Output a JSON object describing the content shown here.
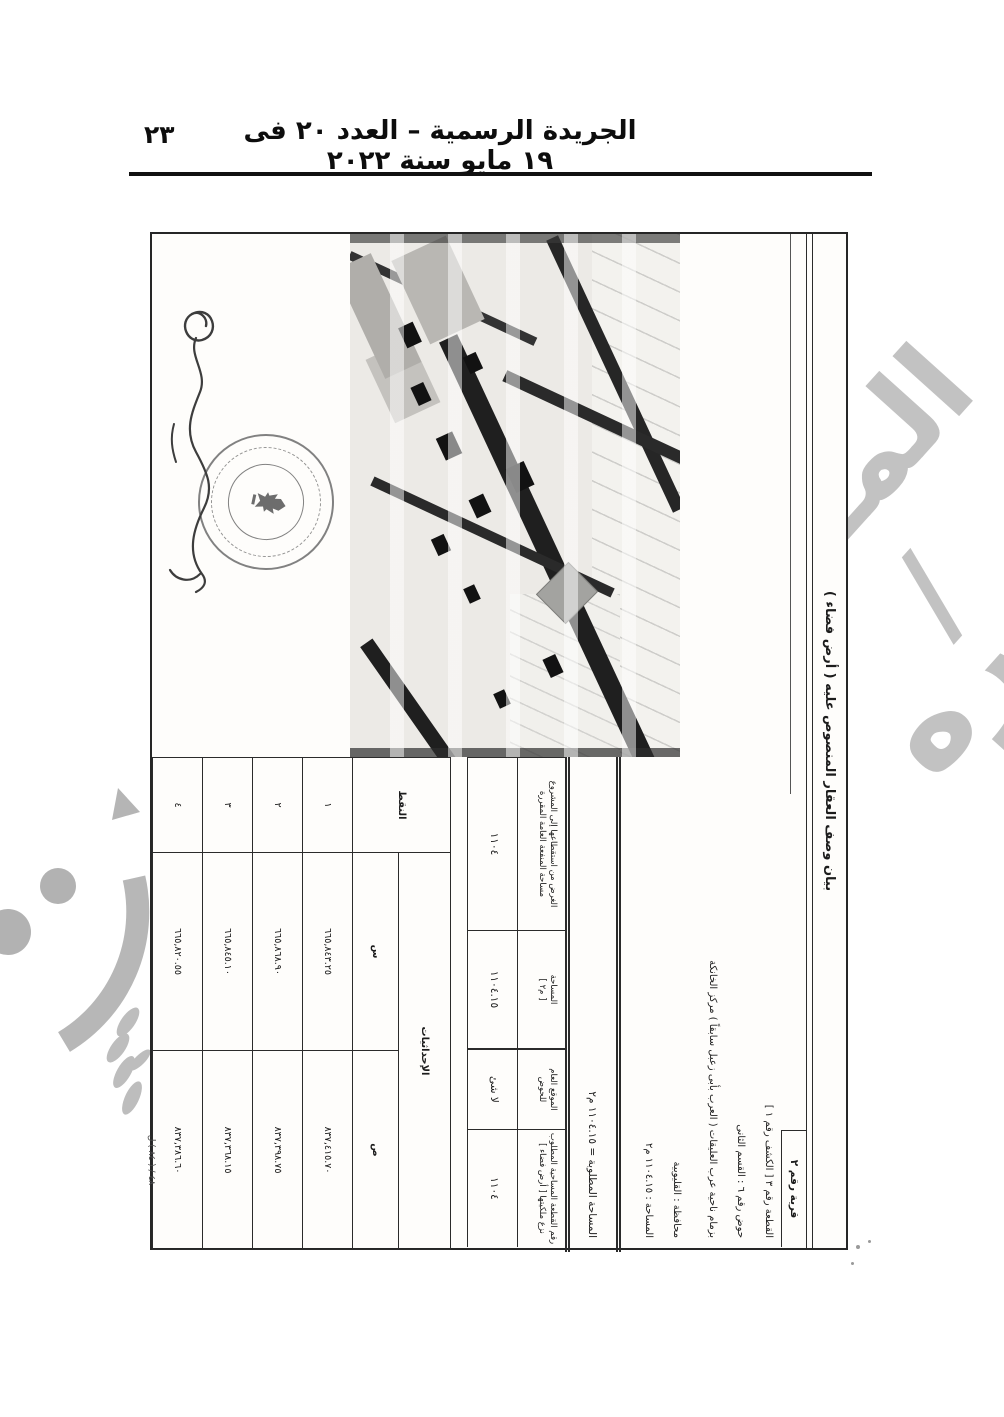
{
  "page": {
    "header": {
      "gazette_title": "الجريدة الرسمية – العدد ٢٠ فى ١٩ مايو سنة ٢٠٢٢",
      "page_number": "٢٣"
    },
    "print_mark": "٤٨ / ( ٨٤ ) ل",
    "watermark": {
      "fragment_top": "المـ /",
      "fragment_bottom": "صوره"
    }
  },
  "doc": {
    "title": "بيان وصف العقار المنصوص عليه ( أرض فضاء )",
    "sheet_label": "قرية رقم ٢",
    "description_lines": [
      "القطعة رقم ٣ [ الكشف رقم ١ ]",
      "حوض رقم ٦ : القسم الثانى",
      "بزمام ناحية عرب العليقات ( العرب بأبى زعبل سابقاً ) مركز الخانكة",
      "محافظة : القليوبية",
      "المساحة : ١١٠٤.١٥ م٢"
    ],
    "summary_line": "المساحة المطلوبة = ١١٠٤.١٥ م٢",
    "parcel_table": {
      "headers": [
        {
          "line1": "الغرض من استقطاعها إلى المشروع",
          "line2": "مساحة المنفعة العامة المقررة"
        },
        {
          "line1": "المساحة",
          "line2": "[ م٢ ]"
        },
        {
          "line1": "الموقع العام",
          "line2": "للحوض"
        },
        {
          "line1": "رقم القطعة المساحية المطلوب",
          "line2": "نزع ملكيتها [ أرض فضاء ]"
        }
      ],
      "values": [
        "١١٠٤",
        "١١٠٤.١٥",
        "لا شئ",
        "١١٠٤"
      ]
    },
    "coords_table": {
      "points_label": "النقط",
      "coords_label": "الإحداثيات",
      "col_x_label": "س",
      "col_y_label": "ص",
      "rows": [
        {
          "point": "١",
          "x": "٦٦٥,٨٤٣.٢٥",
          "y": "٨٣٧,٤١٥.٧٠"
        },
        {
          "point": "٢",
          "x": "٦٦٥,٨٦٨.٩٠",
          "y": "٨٣٧,٣٩٨.٧٥"
        },
        {
          "point": "٣",
          "x": "٦٦٥,٨٤٥.١٠",
          "y": "٨٣٧,٣٦٨.١٥"
        },
        {
          "point": "٤",
          "x": "٦٦٥,٨٢٠.٥٥",
          "y": "٨٣٧,٣٨٦.٦٠"
        }
      ]
    }
  }
}
